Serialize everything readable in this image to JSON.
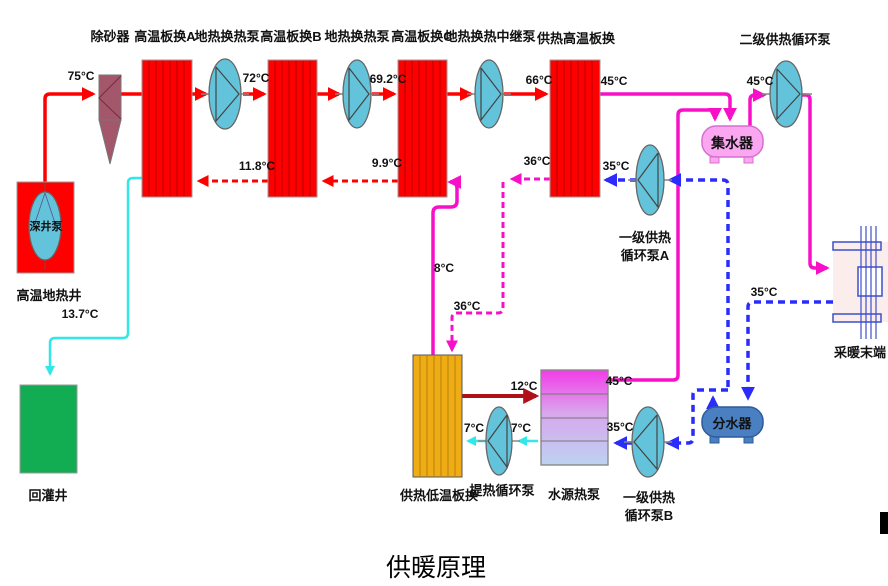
{
  "title": "供暖原理",
  "equipment": {
    "sand_remover": "除砂器",
    "hx_a": "高温板换A",
    "geo_pump_1": "地热换热泵",
    "hx_b": "高温板换B",
    "geo_pump_2": "地热换热泵",
    "hx_c": "高温板换C",
    "geo_relay_pump": "地热换热中继泵",
    "heating_high_hx": "供热高温板换",
    "secondary_heating_pump": "二级供热循环泵",
    "collector": "集水器",
    "primary_pump_a_line1": "一级供热",
    "primary_pump_a_line2": "循环泵A",
    "deep_well_pump": "深井泵",
    "geothermal_well": "高温地热井",
    "reinjection_well": "回灌井",
    "heating_low_hx": "供热低温板换",
    "heat_lift_pump": "提热循环泵",
    "water_source_hp": "水源热泵",
    "primary_pump_b_line1": "一级供热",
    "primary_pump_b_line2": "循环泵B",
    "distributor": "分水器",
    "heating_terminal": "采暖末端"
  },
  "temperatures": {
    "well_out": "75°C",
    "after_pump1": "72°C",
    "after_pump2": "69.2°C",
    "after_pump3": "66°C",
    "hx_d_out": "45°C",
    "collector_out": "45°C",
    "return_b_to_a": "11.8°C",
    "return_c_to_b": "9.9°C",
    "hx_d_return_out": "36°C",
    "pump_a_out": "35°C",
    "low_hx_out": "8°C",
    "mid_return": "36°C",
    "reinjection": "13.7°C",
    "low_hx_to_hp": "12°C",
    "lift_left": "7°C",
    "lift_right": "7°C",
    "hp_supply": "45°C",
    "hp_return": "35°C",
    "terminal_return": "35°C"
  },
  "colors": {
    "geo_hot_supply": "#FF0000",
    "geo_return_dashed": "#FF0000",
    "heating_supply_magenta": "#F810C8",
    "heating_return_blue": "#2B2BFB",
    "cooled_reinjection_cyan": "#30E8E8",
    "hp_feed_dark_red": "#B01018",
    "green_label": "#00B050",
    "exchanger_red": "#FF0000",
    "low_hx_amber": "#EFAC15",
    "well_green": "#12AD52",
    "collector_pink": "#FBA6F1",
    "distributor_blue": "#4A7FC1"
  }
}
